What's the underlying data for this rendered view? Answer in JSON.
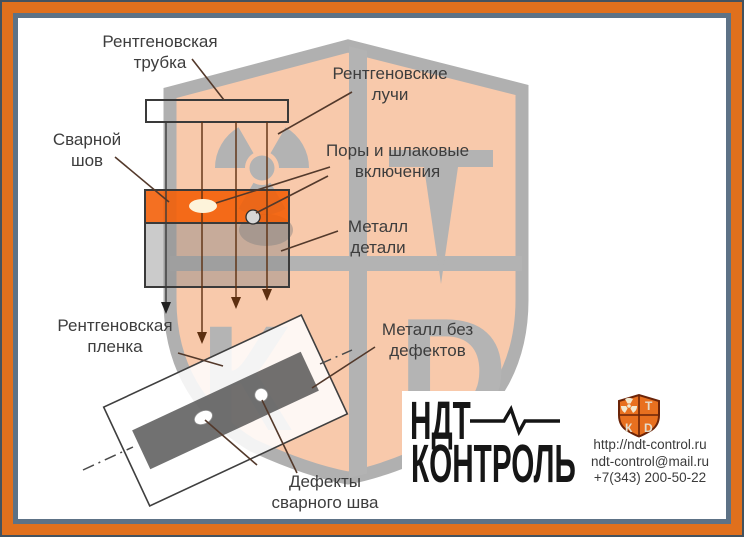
{
  "labels": {
    "tube": {
      "l1": "Рентгеновская",
      "l2": "трубка"
    },
    "weld": {
      "l1": "Сварной",
      "l2": "шов"
    },
    "rays": {
      "l1": "Рентгеновские",
      "l2": "лучи"
    },
    "pores": {
      "l1": "Поры и шлаковые",
      "l2": "включения"
    },
    "metal": {
      "l1": "Металл",
      "l2": "детали"
    },
    "film": {
      "l1": "Рентгеновская",
      "l2": "пленка"
    },
    "no_defects": {
      "l1": "Металл без",
      "l2": "дефектов"
    },
    "defects": {
      "l1": "Дефекты",
      "l2": "сварного шва"
    }
  },
  "logo": {
    "top": "НДТ",
    "bottom": "КОНТРОЛЬ"
  },
  "contacts": {
    "website": "http://ndt-control.ru",
    "email": "ndt-control@mail.ru",
    "phone": "+7(343) 200-50-22"
  },
  "watermark": {
    "letter_top_right": "Т",
    "letter_bottom_left": "К",
    "letter_bottom_right": "D"
  },
  "colors": {
    "frame_orange": "#e0701d",
    "frame_slate": "#5d7286",
    "shield_fill": "#f8c9ab",
    "shield_gray": "#b3b3b3",
    "weld_orange": "#f35c03",
    "logo_shield_orange": "#e8701f",
    "text": "#3d3d3d"
  }
}
